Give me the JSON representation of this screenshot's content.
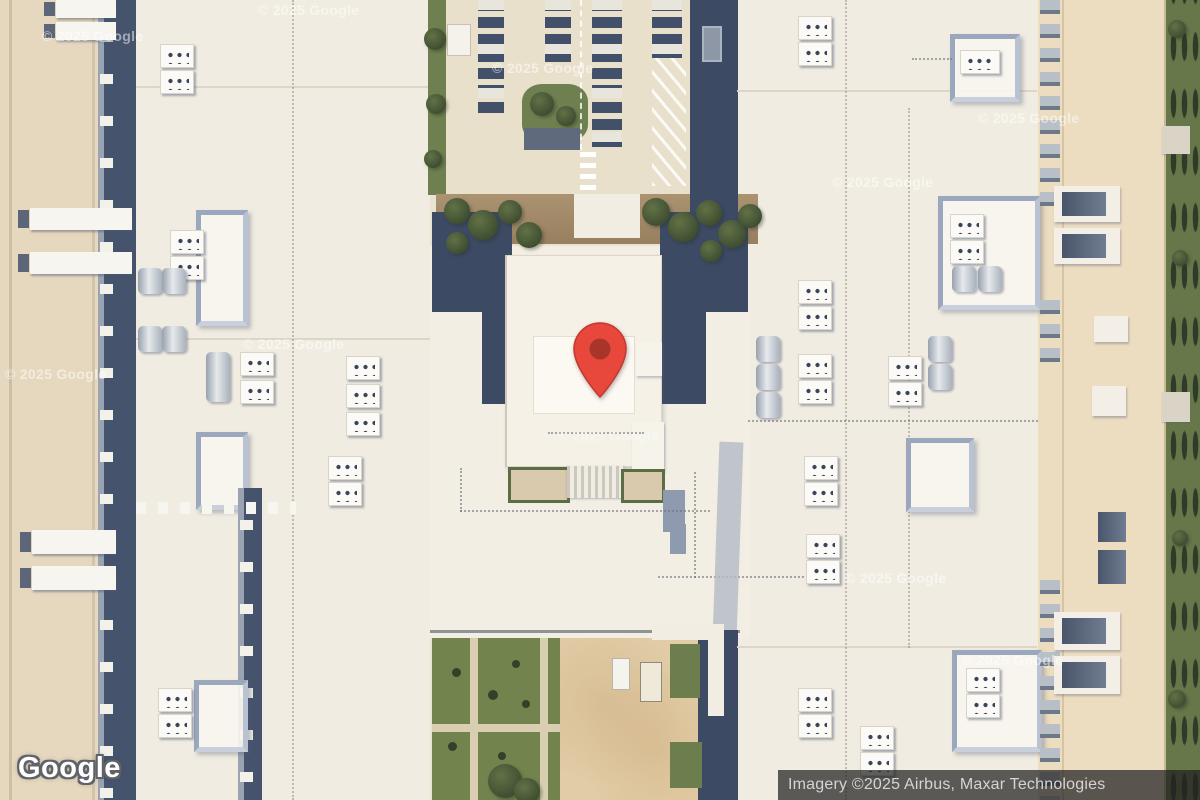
{
  "map_view": {
    "mode": "satellite",
    "branding": {
      "logo": "Google"
    },
    "attribution": "Imagery ©2025 Airbus, Maxar Technologies",
    "watermark": "© 2025 Google",
    "marker": {
      "name": "red-location-pin",
      "body_color": "#E8473B",
      "inner_dot_color": "#A93429"
    }
  }
}
